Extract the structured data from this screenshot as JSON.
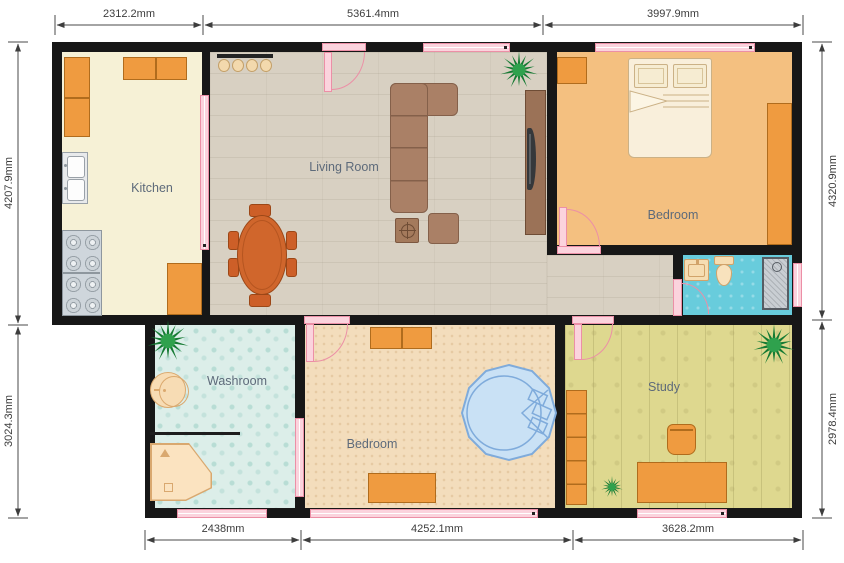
{
  "title": "Floor plan",
  "rooms": {
    "kitchen": {
      "label": "Kitchen"
    },
    "living_room": {
      "label": "Living Room"
    },
    "bedroom_main": {
      "label": "Bedroom"
    },
    "washroom": {
      "label": "Washroom"
    },
    "bedroom_second": {
      "label": "Bedroom"
    },
    "study": {
      "label": "Study"
    }
  },
  "dimensions": {
    "top_1": "2312.2mm",
    "top_2": "5361.4mm",
    "top_3": "3997.9mm",
    "left_1": "4207.9mm",
    "left_2": "3024.3mm",
    "right_1": "4320.9mm",
    "right_2": "2978.4mm",
    "bottom_1": "2438mm",
    "bottom_2": "4252.1mm",
    "bottom_3": "3628.2mm"
  },
  "colors": {
    "wall": "#171717",
    "opening_pink": "#fbd3dd",
    "opening_pink_border": "#ec8fa6",
    "furniture_orange": "#ef9b40",
    "dining_rust": "#cd5f28",
    "sofa_brown": "#aa8066",
    "bed_cream": "#f9efdb",
    "bath_floor_cyan": "#68ccdc",
    "tub_blue": "#c9e1f5",
    "plant_green": "#157a33",
    "dimension_text": "#3d3d3d",
    "room_label_text": "#5d6a7a"
  }
}
